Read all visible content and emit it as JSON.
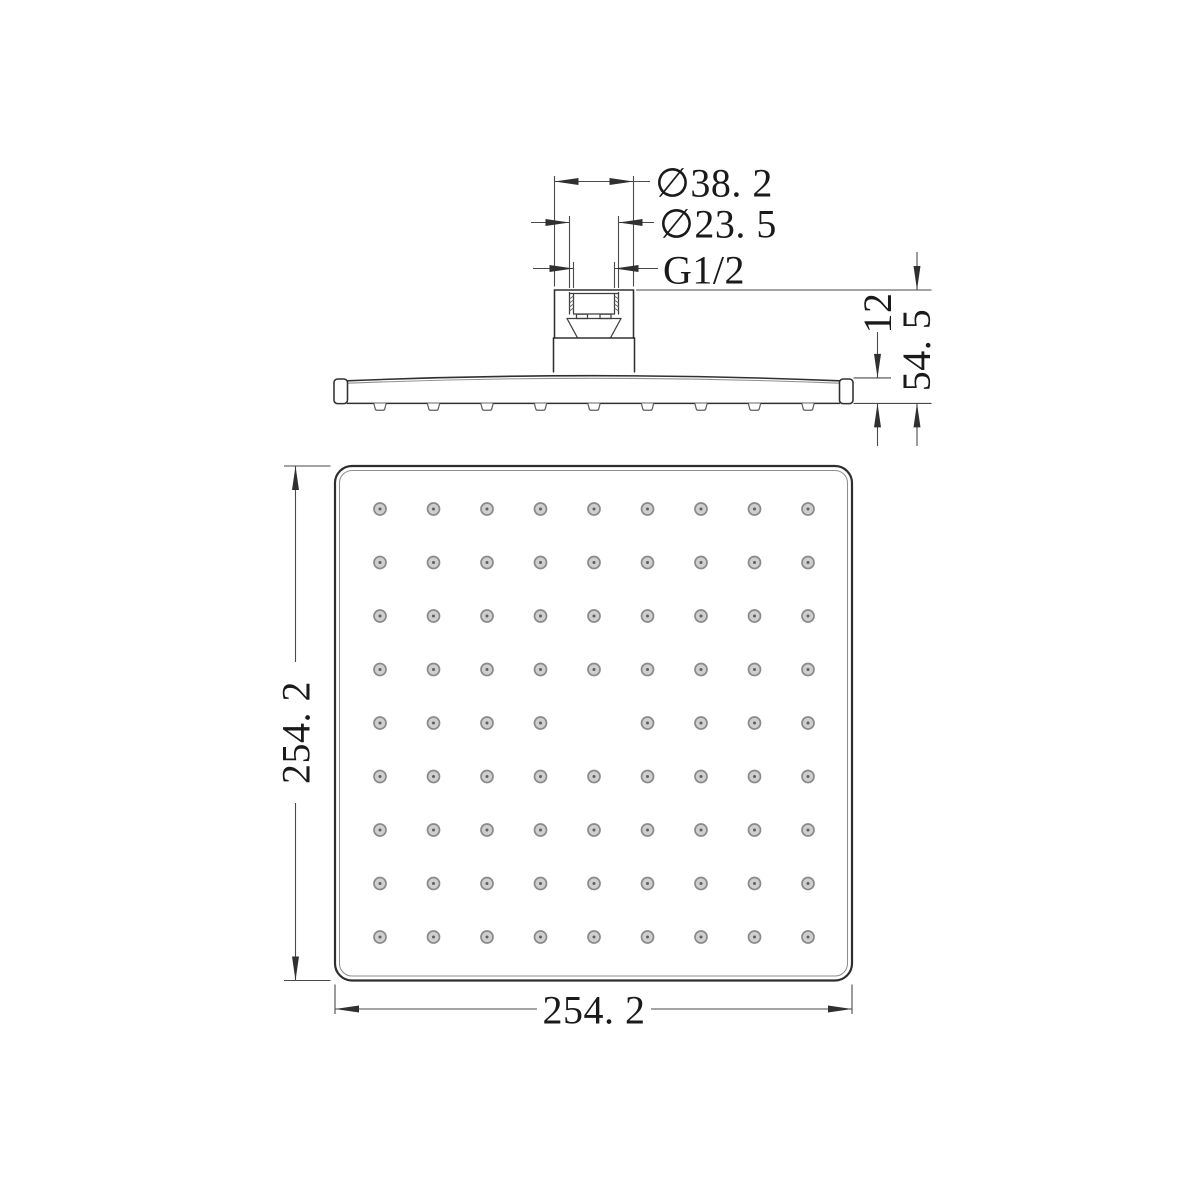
{
  "page": {
    "type": "technical-drawing",
    "subject": "square rain shower head with G1/2 connector, side elevation and bottom face views"
  },
  "colors": {
    "line": "#303030",
    "thin": "#4a4a4a",
    "light": "#8f8f8f",
    "hole_ring": "#8a8a8a",
    "hole_fill": "#cfcfcf",
    "hole_dot": "#5f5f5f",
    "text": "#1a1a1a",
    "bg": "#ffffff"
  },
  "dims": {
    "d38": {
      "label": "∅38. 2"
    },
    "d23": {
      "label": "∅23. 5"
    },
    "g12": {
      "label": "G1/2"
    },
    "t12": {
      "label": "12"
    },
    "h545": {
      "label": "54. 5"
    },
    "w_left": {
      "label": "254. 2"
    },
    "w_bottom": {
      "label": "254. 2"
    }
  },
  "nozzle_grid": {
    "rows": 9,
    "cols": 9,
    "spacing": 53.5,
    "center_x": 594,
    "center_y": 723,
    "hole_radius": 6,
    "dot_radius": 1.5,
    "skip_center": true,
    "visible_hole_count": 80
  },
  "side_profile": {
    "nozzle_count": 9,
    "nozzle_y": 403.4
  }
}
